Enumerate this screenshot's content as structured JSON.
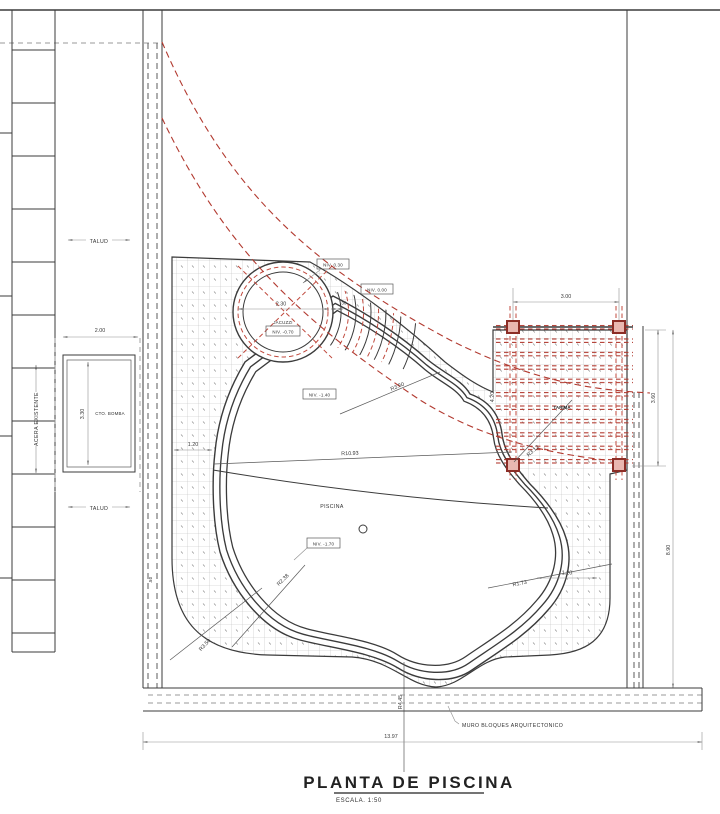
{
  "title": {
    "name": "PLANTA DE PISCINA",
    "scale": "ESCALA. 1:50"
  },
  "labels": {
    "talud_top": "TALUD",
    "talud_bottom": "TALUD",
    "acera": "ACERA EXISTENTE",
    "cto_bomba": "CTO. BOMBA",
    "jacuzzi": "JACUZZI",
    "piscina": "PISCINA",
    "tarima": "TARIMA",
    "muro": "MURO BLOQUES ARQUITECTONICO"
  },
  "levels": {
    "coping_top": "NIV. 0.30",
    "deck": "NIV. 0.00",
    "jacuzzi": "NIV. -0.70",
    "shallow": "NIV. -1.40",
    "deep": "NIV. -1.70"
  },
  "dims": {
    "bomba_width": "2.00",
    "bomba_height": "3.30",
    "jacuzzi_diameter": "2.30",
    "coping_width": ".30",
    "deck_left": "1.20",
    "deck_right": "1.20",
    "pergola_width": "3.00",
    "pergola_height": "3.60",
    "pergola_left": "4.20",
    "site_height": "8.90",
    "wall_width": ".50",
    "site_width": "13.97"
  },
  "radii": {
    "stairs": "R3.50",
    "main_arc": "R10.93",
    "pergola_arc": "R3.12",
    "lobe_right": "R1.73",
    "corner_inner": "R2.38",
    "corner_outer": "R3.50",
    "bottom_lobe": "R4.45"
  },
  "colors": {
    "accent_red": "#b23a30",
    "line_dark": "#3b3b3b"
  }
}
